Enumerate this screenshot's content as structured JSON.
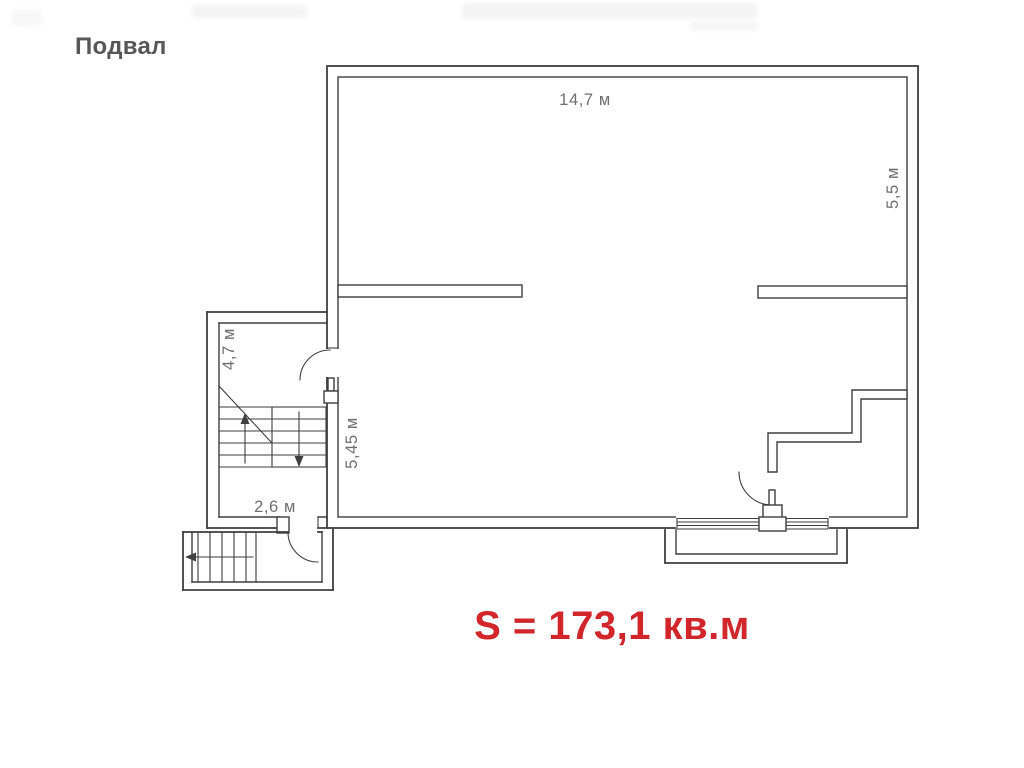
{
  "header": {
    "title": "Подвал"
  },
  "plan": {
    "dimensions": {
      "top_width": "14,7 м",
      "right_height": "5,5 м",
      "inner_height": "5,45 м",
      "annex_height": "4,7 м",
      "annex_width": "2,6 м"
    },
    "area_label": "S = 173,1 кв.м",
    "colors": {
      "wall": "#3f3f3f",
      "dimension_text": "#6f6f6f",
      "title_text": "#575757",
      "area_text": "#d2262b"
    }
  }
}
